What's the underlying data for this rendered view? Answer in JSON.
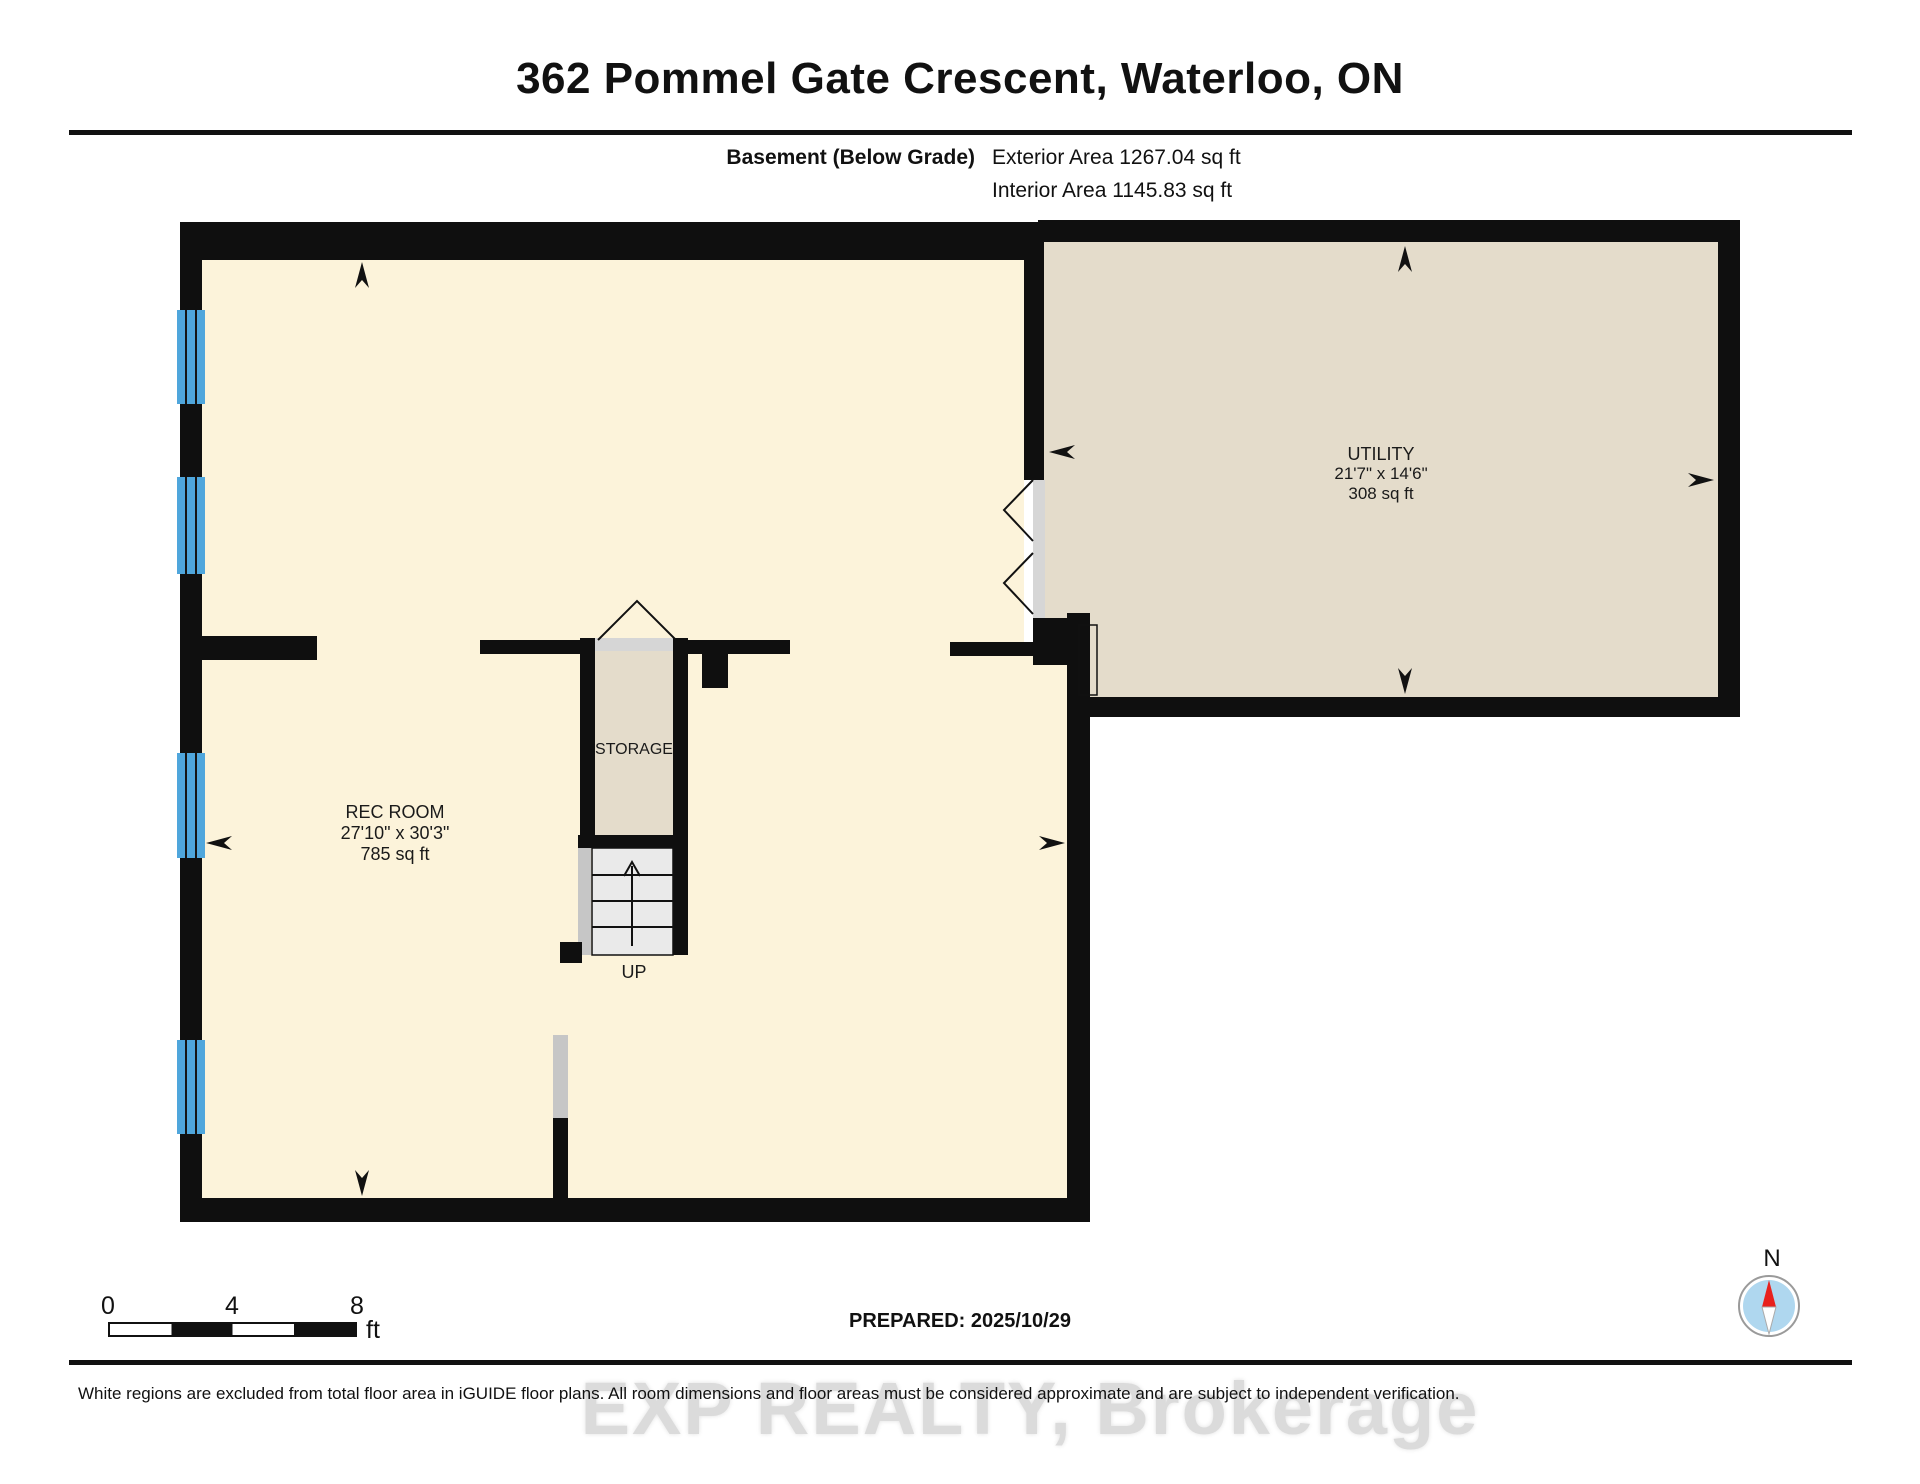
{
  "header": {
    "title": "362 Pommel Gate Crescent, Waterloo, ON",
    "floor_label": "Basement (Below Grade)",
    "exterior_area": "Exterior Area 1267.04 sq ft",
    "interior_area": "Interior Area 1145.83 sq ft"
  },
  "rooms": {
    "rec_room": {
      "name": "REC ROOM",
      "dimensions": "27'10\" x 30'3\"",
      "area": "785 sq ft"
    },
    "storage": {
      "name": "STORAGE"
    },
    "utility": {
      "name": "UTILITY",
      "dimensions": "21'7\" x 14'6\"",
      "area": "308 sq ft"
    },
    "stairs": {
      "direction_label": "UP"
    }
  },
  "scale_bar": {
    "ticks": [
      "0",
      "4",
      "8"
    ],
    "unit": "ft"
  },
  "compass": {
    "north_label": "N"
  },
  "footer": {
    "prepared_label": "PREPARED: 2025/10/29",
    "disclaimer": "White regions are excluded from total floor area in iGUIDE floor plans. All room dimensions and floor areas must be considered approximate and are subject to independent verification.",
    "watermark": "EXP REALTY, Brokerage"
  },
  "colors": {
    "wall": "#0f0f0f",
    "room_cream": "#FCF3DA",
    "room_beige": "#E4DCCB",
    "stair_gray": "#EAEAEA",
    "trim_gray": "#D6D6D6",
    "side_gray": "#C6C6C6",
    "window_blue": "#4FA6DC",
    "compass_blue": "#AFD7EF",
    "compass_red": "#E8211D",
    "watermark_gray": "#DBDBDB"
  }
}
